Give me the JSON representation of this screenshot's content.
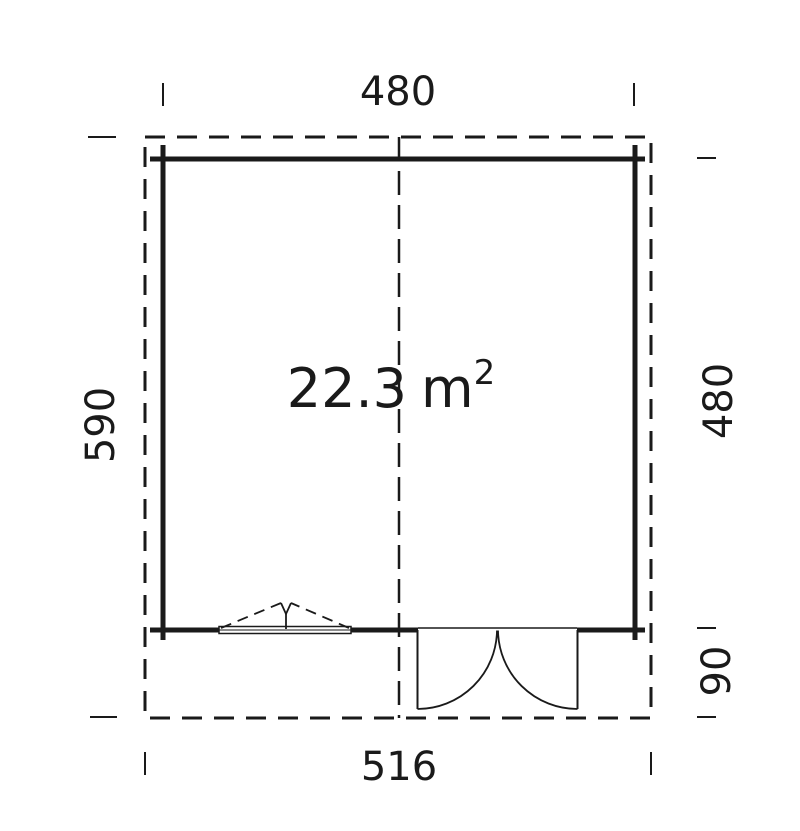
{
  "diagram": {
    "type": "floor-plan",
    "area_label": {
      "value": "22.3",
      "unit": "m",
      "exponent": "2"
    },
    "dimensions": {
      "width_top": "480",
      "depth_left": "590",
      "depth_right": "480",
      "porch_depth": "90",
      "width_bottom": "516"
    },
    "features": {
      "window": "tilt-window-bottom-left",
      "door": "double-outswing-door-bottom-right",
      "roof_overhang": "dashed-outline",
      "ridge": "dashed-center-line"
    },
    "colors": {
      "line": "#1a1a1a",
      "background": "#ffffff"
    }
  }
}
